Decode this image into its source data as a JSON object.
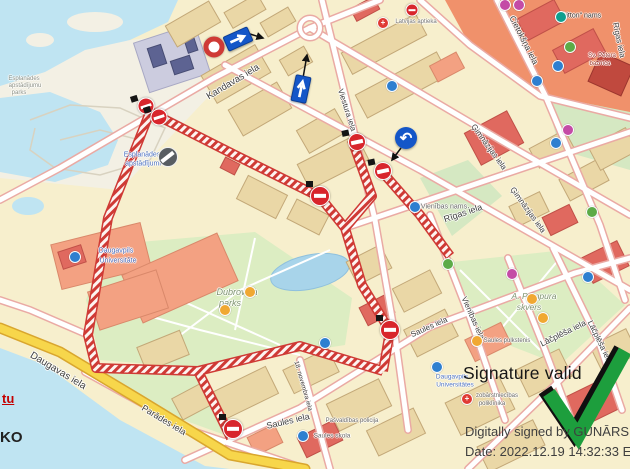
{
  "signature": {
    "status": "Signature valid",
    "signed_by": "Digitally signed by GUNĀRS HME",
    "date_line": "Date: 2022.12.19 14:32:33 EET",
    "check_color": "#1d9e3d"
  },
  "edge_text": {
    "red": "tu",
    "black": "KO"
  },
  "colors": {
    "route_red": "#cf3a35",
    "sign_blue": "#1456c8",
    "water": "#bfe4f2",
    "park_green": "#dcedc2",
    "road_casing": "#eaaaa4",
    "main_road_yellow": "#f7d64b"
  },
  "map": {
    "street_labels": [
      {
        "t": "Kandavas iela",
        "x": 233,
        "y": 82,
        "r": -31,
        "s": 9.5
      },
      {
        "t": "Viestura iela",
        "x": 347,
        "y": 110,
        "r": 72,
        "s": 8
      },
      {
        "t": "Cietokšņa iela",
        "x": 524,
        "y": 40,
        "r": 63,
        "s": 8.5
      },
      {
        "t": "Rīgas iela",
        "x": 619,
        "y": 40,
        "r": 78,
        "s": 8
      },
      {
        "t": "Ģimnāzijas iela",
        "x": 489,
        "y": 147,
        "r": 54,
        "s": 8
      },
      {
        "t": "Ģimnāzijas iela",
        "x": 528,
        "y": 210,
        "r": 54,
        "s": 8
      },
      {
        "t": "Rīgas iela",
        "x": 463,
        "y": 213,
        "r": -19,
        "s": 9
      },
      {
        "t": "Vienības iela",
        "x": 473,
        "y": 318,
        "r": 66,
        "s": 8
      },
      {
        "t": "Saules iela",
        "x": 288,
        "y": 421,
        "r": -13,
        "s": 9
      },
      {
        "t": "Saules iela",
        "x": 429,
        "y": 327,
        "r": -24,
        "s": 8
      },
      {
        "t": "Lāčplēša iela",
        "x": 563,
        "y": 333,
        "r": -26,
        "s": 8.5
      },
      {
        "t": "Lāčplēša iela",
        "x": 600,
        "y": 342,
        "r": 64,
        "s": 8
      },
      {
        "t": "Daugavas iela",
        "x": 58,
        "y": 371,
        "r": 31,
        "s": 10
      },
      {
        "t": "Parādes iela",
        "x": 164,
        "y": 420,
        "r": 31,
        "s": 9
      },
      {
        "t": "18. novembra iela",
        "x": 303,
        "y": 386,
        "r": 74,
        "s": 6.5
      }
    ],
    "place_labels": [
      {
        "t": "Dubrovina",
        "x": 237,
        "y": 292,
        "s": 9,
        "c": "#7f9471",
        "i": 1
      },
      {
        "t": "parks",
        "x": 230,
        "y": 303,
        "s": 9,
        "c": "#7f9471",
        "i": 1
      },
      {
        "t": "A. Pumpura",
        "x": 534,
        "y": 296,
        "s": 8.5,
        "c": "#7f9471",
        "i": 1
      },
      {
        "t": "skvērs",
        "x": 529,
        "y": 307,
        "s": 8.5,
        "c": "#7f9471",
        "i": 1
      },
      {
        "t": "Esplanādes",
        "x": 24,
        "y": 79,
        "s": 6,
        "c": "#8e9287"
      },
      {
        "t": "apstādījumu",
        "x": 25,
        "y": 86,
        "s": 6,
        "c": "#8e9287"
      },
      {
        "t": "parks",
        "x": 19,
        "y": 93,
        "s": 6,
        "c": "#8e9287"
      },
      {
        "t": "Esplanādes",
        "x": 142,
        "y": 155,
        "s": 7,
        "c": "#4f74c4"
      },
      {
        "t": "apstādījumi",
        "x": 143,
        "y": 164,
        "s": 7,
        "c": "#4f74c4"
      },
      {
        "t": "Daugavpils",
        "x": 116,
        "y": 251,
        "s": 7,
        "c": "#4f74c4"
      },
      {
        "t": "Universitāte",
        "x": 118,
        "y": 261,
        "s": 7,
        "c": "#4f74c4"
      },
      {
        "t": "Daugavpils",
        "x": 452,
        "y": 377,
        "s": 6.5,
        "c": "#4f74c4"
      },
      {
        "t": "Universitātes",
        "x": 455,
        "y": 385,
        "s": 6.5,
        "c": "#4f74c4"
      },
      {
        "t": "zobārstniecības",
        "x": 497,
        "y": 396,
        "s": 6,
        "c": "#6b6b6b"
      },
      {
        "t": "poliklīnika",
        "x": 492,
        "y": 404,
        "s": 6,
        "c": "#6b6b6b"
      },
      {
        "t": "\"Ditton\" nams",
        "x": 580,
        "y": 16,
        "s": 7,
        "c": "#3c3c3c"
      },
      {
        "t": "Latvijas aptieka",
        "x": 416,
        "y": 22,
        "s": 6,
        "c": "#777777"
      },
      {
        "t": "Vienības nams",
        "x": 444,
        "y": 207,
        "s": 7,
        "c": "#6b6b6b"
      },
      {
        "t": "Saules skola",
        "x": 332,
        "y": 436,
        "s": 6.5,
        "c": "#6b6b6b"
      },
      {
        "t": "Saules pulkstenis",
        "x": 507,
        "y": 341,
        "s": 6,
        "c": "#6b6b6b"
      },
      {
        "t": "Pašvaldības policija",
        "x": 352,
        "y": 421,
        "s": 6,
        "c": "#6b6b6b"
      },
      {
        "t": "Sv. Pētera",
        "x": 602,
        "y": 56,
        "s": 6,
        "c": "#a0453c"
      },
      {
        "t": "baznīca",
        "x": 600,
        "y": 64,
        "s": 6,
        "c": "#a0453c"
      }
    ],
    "pois": [
      {
        "x": 558,
        "y": 66,
        "c": "blue"
      },
      {
        "x": 537,
        "y": 81,
        "c": "blue"
      },
      {
        "x": 392,
        "y": 86,
        "c": "blue"
      },
      {
        "x": 415,
        "y": 207,
        "c": "blue"
      },
      {
        "x": 75,
        "y": 257,
        "c": "blue"
      },
      {
        "x": 303,
        "y": 436,
        "c": "blue"
      },
      {
        "x": 325,
        "y": 343,
        "c": "blue"
      },
      {
        "x": 588,
        "y": 277,
        "c": "blue"
      },
      {
        "x": 556,
        "y": 143,
        "c": "blue"
      },
      {
        "x": 437,
        "y": 367,
        "c": "blue"
      },
      {
        "x": 383,
        "y": 23,
        "c": "red",
        "g": "+"
      },
      {
        "x": 467,
        "y": 399,
        "c": "red",
        "g": "+"
      },
      {
        "x": 505,
        "y": 5,
        "c": "magenta"
      },
      {
        "x": 519,
        "y": 5,
        "c": "magenta"
      },
      {
        "x": 512,
        "y": 274,
        "c": "magenta"
      },
      {
        "x": 568,
        "y": 130,
        "c": "magenta"
      },
      {
        "x": 561,
        "y": 17,
        "c": "teal"
      },
      {
        "x": 592,
        "y": 212,
        "c": "green"
      },
      {
        "x": 448,
        "y": 264,
        "c": "green"
      },
      {
        "x": 570,
        "y": 47,
        "c": "green"
      },
      {
        "x": 225,
        "y": 310,
        "c": "orange"
      },
      {
        "x": 250,
        "y": 292,
        "c": "orange"
      },
      {
        "x": 532,
        "y": 299,
        "c": "orange"
      },
      {
        "x": 543,
        "y": 318,
        "c": "orange"
      },
      {
        "x": 477,
        "y": 341,
        "c": "orange"
      }
    ],
    "poi_colors": {
      "blue": "#2e7fd0",
      "magenta": "#c44ba6",
      "teal": "#0e9f8f",
      "red": "#e03a34",
      "green": "#5cab48",
      "orange": "#f0a832"
    },
    "signs": [
      {
        "type": "no_entry",
        "x": 146,
        "y": 106,
        "d": 17,
        "rot": -18
      },
      {
        "type": "no_entry",
        "x": 159,
        "y": 117,
        "d": 17,
        "rot": -18
      },
      {
        "type": "no_entry_gray",
        "x": 168,
        "y": 157,
        "d": 20,
        "rot": 0
      },
      {
        "type": "no_vehicles",
        "x": 214,
        "y": 47,
        "d": 21
      },
      {
        "type": "one_way",
        "x": 238,
        "y": 39,
        "w": 27,
        "h": 16,
        "rot": -24,
        "dir": "right"
      },
      {
        "type": "one_way",
        "x": 301,
        "y": 89,
        "w": 16,
        "h": 27,
        "rot": 12,
        "dir": "up"
      },
      {
        "type": "turn_left",
        "x": 406,
        "y": 138,
        "d": 22,
        "glyph": "↶"
      },
      {
        "type": "no_entry",
        "x": 357,
        "y": 142,
        "d": 18,
        "rot": -12
      },
      {
        "type": "no_entry",
        "x": 383,
        "y": 171,
        "d": 18,
        "rot": -12
      },
      {
        "type": "no_entry",
        "x": 320,
        "y": 196,
        "d": 20,
        "rot": 0
      },
      {
        "type": "no_entry",
        "x": 390,
        "y": 330,
        "d": 20,
        "rot": 0
      },
      {
        "type": "no_entry",
        "x": 233,
        "y": 429,
        "d": 20,
        "rot": 0
      },
      {
        "type": "no_entry",
        "x": 412,
        "y": 10,
        "d": 13,
        "rot": 0,
        "flag": false
      }
    ]
  }
}
